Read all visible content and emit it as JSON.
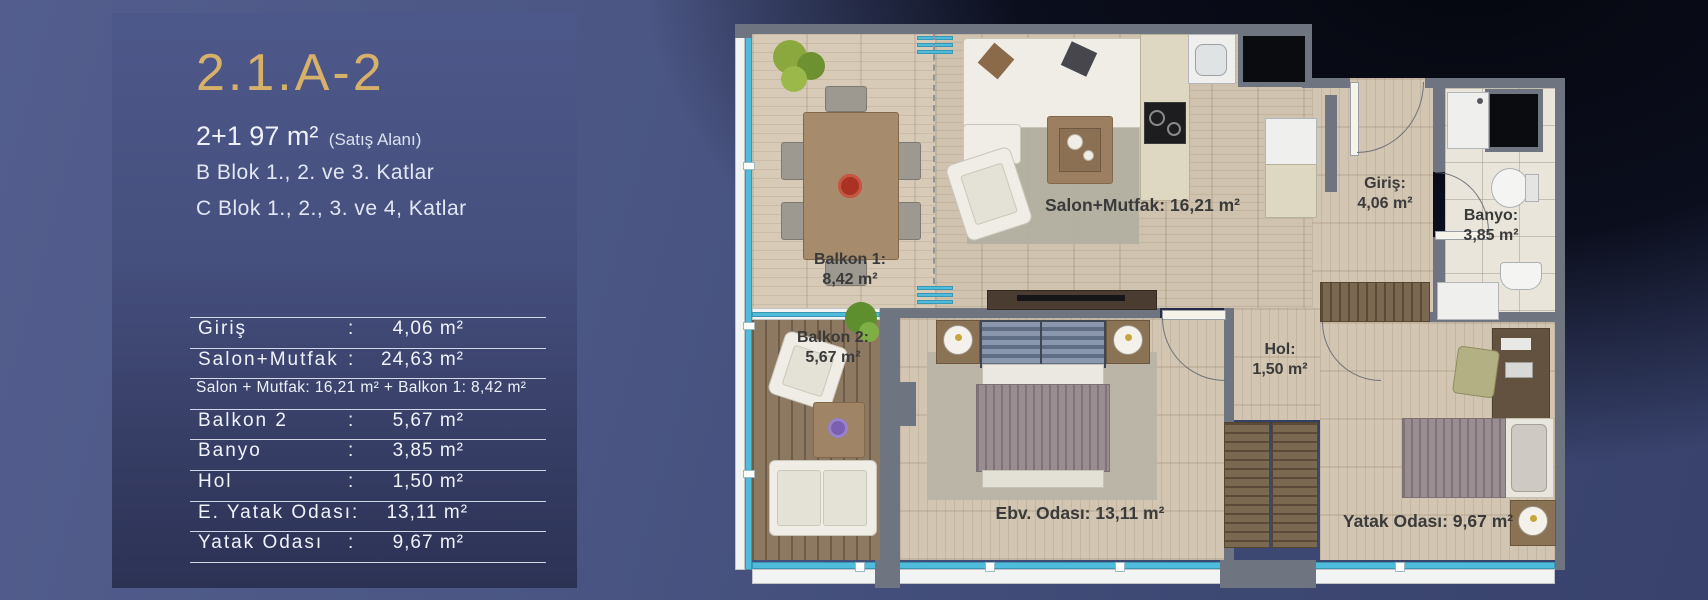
{
  "panel": {
    "title": "2.1.A-2",
    "area_main": "2+1 97 m²",
    "area_note": "(Satış Alanı)",
    "block_line_1": "B Blok 1., 2. ve 3. Katlar",
    "block_line_2": "C Blok 1., 2., 3. ve 4, Katlar",
    "table": {
      "rows": [
        {
          "label": "Giriş",
          "sep": ":",
          "value": "4,06 m²"
        },
        {
          "label": "Salon+Mutfak",
          "sep": ":",
          "value": "24,63 m²"
        },
        {
          "label": "Balkon 2",
          "sep": ":",
          "value": "5,67 m²"
        },
        {
          "label": "Banyo",
          "sep": ":",
          "value": "3,85 m²"
        },
        {
          "label": "Hol",
          "sep": ":",
          "value": "1,50 m²"
        },
        {
          "label": "E. Yatak Odası",
          "sep": ":",
          "value": "13,11 m²"
        },
        {
          "label": "Yatak Odası",
          "sep": ":",
          "value": "9,67 m²"
        }
      ],
      "note": "Salon + Mutfak: 16,21 m² + Balkon 1: 8,42 m²"
    }
  },
  "plan": {
    "rooms": [
      {
        "name": "balkon-1",
        "label": "Balkon 1:",
        "area": "8,42 m²"
      },
      {
        "name": "salon-mutfak",
        "label": "Salon+Mutfak: 16,21 m²"
      },
      {
        "name": "giris",
        "label": "Giriş:",
        "area": "4,06 m²"
      },
      {
        "name": "banyo",
        "label": "Banyo:",
        "area": "3,85 m²"
      },
      {
        "name": "balkon-2",
        "label": "Balkon 2:",
        "area": "5,67 m²"
      },
      {
        "name": "ebv-odasi",
        "label": "Ebv. Odası: 13,11 m²"
      },
      {
        "name": "hol",
        "label": "Hol:",
        "area": "1,50 m²"
      },
      {
        "name": "yatak-odasi",
        "label": "Yatak Odası: 9,67 m²"
      }
    ],
    "colors": {
      "accent_gold": "#d7b06a",
      "glass_cyan": "#4fbcdc",
      "wall_gray": "#6e7580"
    }
  }
}
